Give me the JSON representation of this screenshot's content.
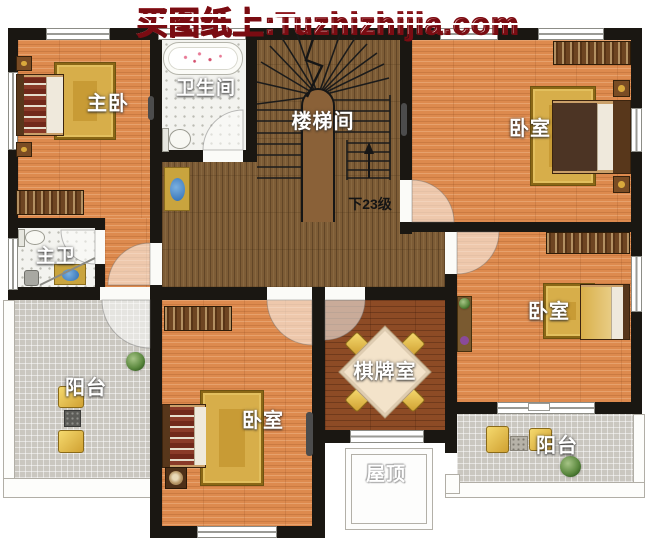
{
  "site": {
    "title": "买图纸上:Tuzhizhijia.com"
  },
  "labels": {
    "master_bedroom": "主卧",
    "bathroom": "卫生间",
    "stair_hall": "楼梯间",
    "stairs_note": "下23级",
    "bedroom_top_right": "卧室",
    "master_bath": "主卫",
    "balcony_left": "阳台",
    "bedroom_bottom": "卧室",
    "chess_room": "棋牌室",
    "bedroom_right": "卧室",
    "balcony_right": "阳台",
    "roof": "屋顶"
  },
  "colors": {
    "watermark_red": "#c41520",
    "wall_black": "#1a1712",
    "wood_orange": "#dd8a4e",
    "wood_dark": "#7d5c36",
    "wood_red": "#8d4b25",
    "tile_white": "#f3f3ef",
    "tile_gray": "#cac7c0",
    "rug_gold": "#c89b35"
  }
}
